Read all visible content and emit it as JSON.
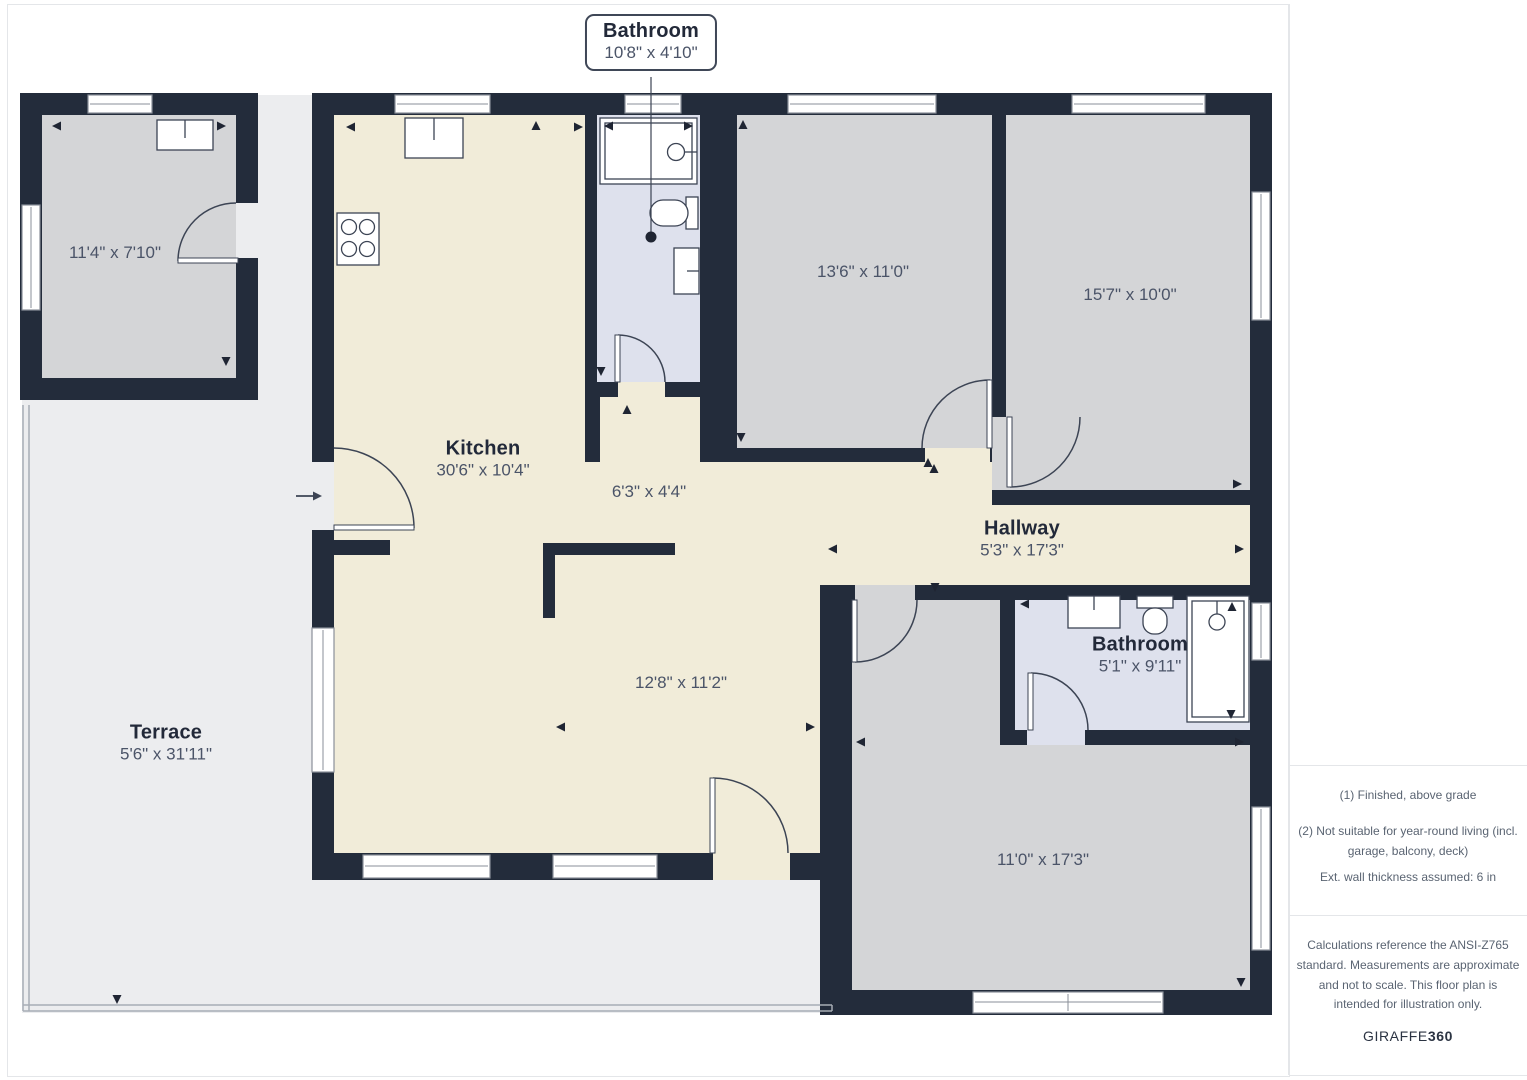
{
  "plan": {
    "callout": {
      "title": "Bathroom",
      "dims": "10'8\" x 4'10\""
    },
    "rooms": {
      "storage": {
        "dims": "11'4\" x 7'10\""
      },
      "kitchen": {
        "name": "Kitchen",
        "dims": "30'6\" x 10'4\""
      },
      "passage": {
        "dims": "6'3\" x 4'4\""
      },
      "bedroom1": {
        "dims": "13'6\" x 11'0\""
      },
      "bedroom2": {
        "dims": "15'7\" x 10'0\""
      },
      "hallway": {
        "name": "Hallway",
        "dims": "5'3\" x 17'3\""
      },
      "living": {
        "dims": "12'8\" x 11'2\""
      },
      "bathroom": {
        "name": "Bathroom",
        "dims": "5'1\" x 9'11\""
      },
      "bedroom3": {
        "dims": "11'0\" x 17'3\""
      },
      "terrace": {
        "name": "Terrace",
        "dims": "5'6\" x 31'11\""
      }
    }
  },
  "sidebar": {
    "notes": [
      "(1) Finished, above grade",
      "(2) Not suitable for year-round living (incl. garage, balcony, deck)",
      "Ext. wall thickness assumed: 6 in"
    ],
    "disclaimer": "Calculations reference the ANSI-Z765 standard. Measurements are approximate and not to scale. This floor plan is intended for illustration only.",
    "brand": {
      "name": "GIRAFFE",
      "suffix": "360"
    }
  },
  "colors": {
    "wall": "#232c3b",
    "room_floor": "#d4d5d7",
    "wet_floor": "#dee1ed",
    "main_floor": "#f1ecd9",
    "terrace": "#ecedef"
  }
}
